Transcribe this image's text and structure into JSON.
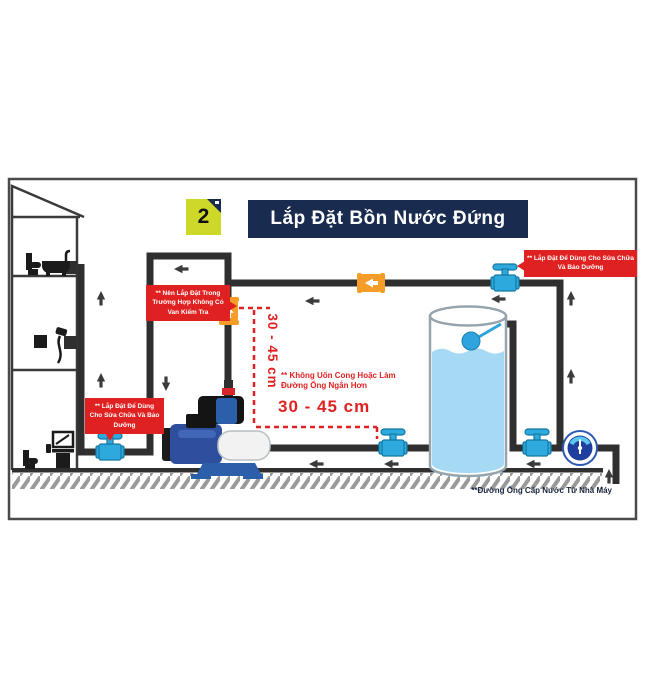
{
  "header": {
    "badge": "2",
    "title": "Lắp Đặt Bồn Nước Đứng"
  },
  "annotations": {
    "check_valve_tip": "** Nên Lắp Đặt Trong Trường Hợp Không Có Van Kiểm Tra",
    "service_valve_tip_left": "** Lắp Đặt Để Dùng Cho Sửa Chữa Và Bảo Dưỡng",
    "service_valve_tip_right": "** Lắp Đặt Để Dùng Cho Sửa Chữa Và Bảo Dưỡng",
    "pipe_rule": "** Không Uốn Cong Hoặc Làm Đường Ống Ngắn Hơn",
    "distance_horizontal": "30 - 45 cm",
    "distance_vertical": "30 - 45 cm"
  },
  "footer": {
    "supply_line_note": "**Đường Ống Cấp Nước Từ Nhà Máy"
  },
  "components": {
    "tank": "storage-tank-with-float-valve",
    "pump": "booster-pump-with-pressure-switch",
    "meter": "water-meter",
    "gate_valves": 4,
    "check_valves": 2
  },
  "colors": {
    "banner": "#1a2b50",
    "badge": "#cdd829",
    "alert_red": "#e02121",
    "valve_blue": "#2ea9dd",
    "check_orange": "#f59d28",
    "pipe": "#2f2f2f",
    "water": "#a6d9f4",
    "float_blue": "#2fa3dd",
    "meter_navy": "#1e3f9e",
    "ink": "#16233c"
  }
}
